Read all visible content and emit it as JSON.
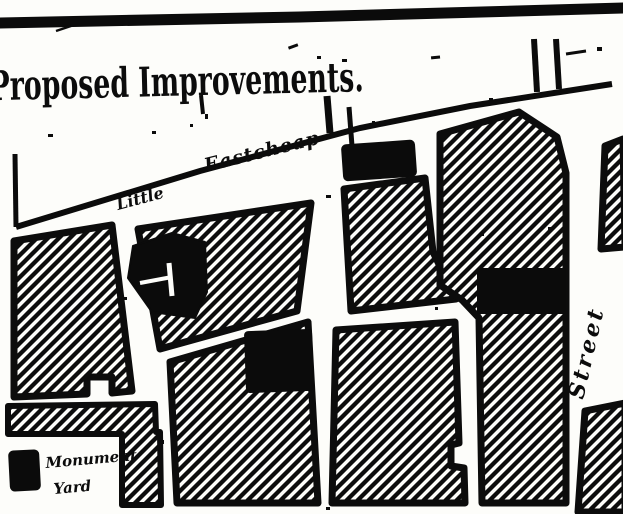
{
  "page": {
    "title": "Proposed Improvements."
  },
  "map": {
    "street_labels": {
      "little": "Little",
      "eastcheap": "Eastcheap",
      "street": "Street"
    },
    "annotations": {
      "monument_yard_line1": "Monument",
      "monument_yard_line2": "Yard"
    },
    "symbols": {
      "church_cross": "cross-mark",
      "solid_building": "black-fill-block",
      "city_block": "diagonal-hatch-block"
    },
    "colors": {
      "ink": "#0d0d0d",
      "paper": "#fdfdfa"
    }
  }
}
